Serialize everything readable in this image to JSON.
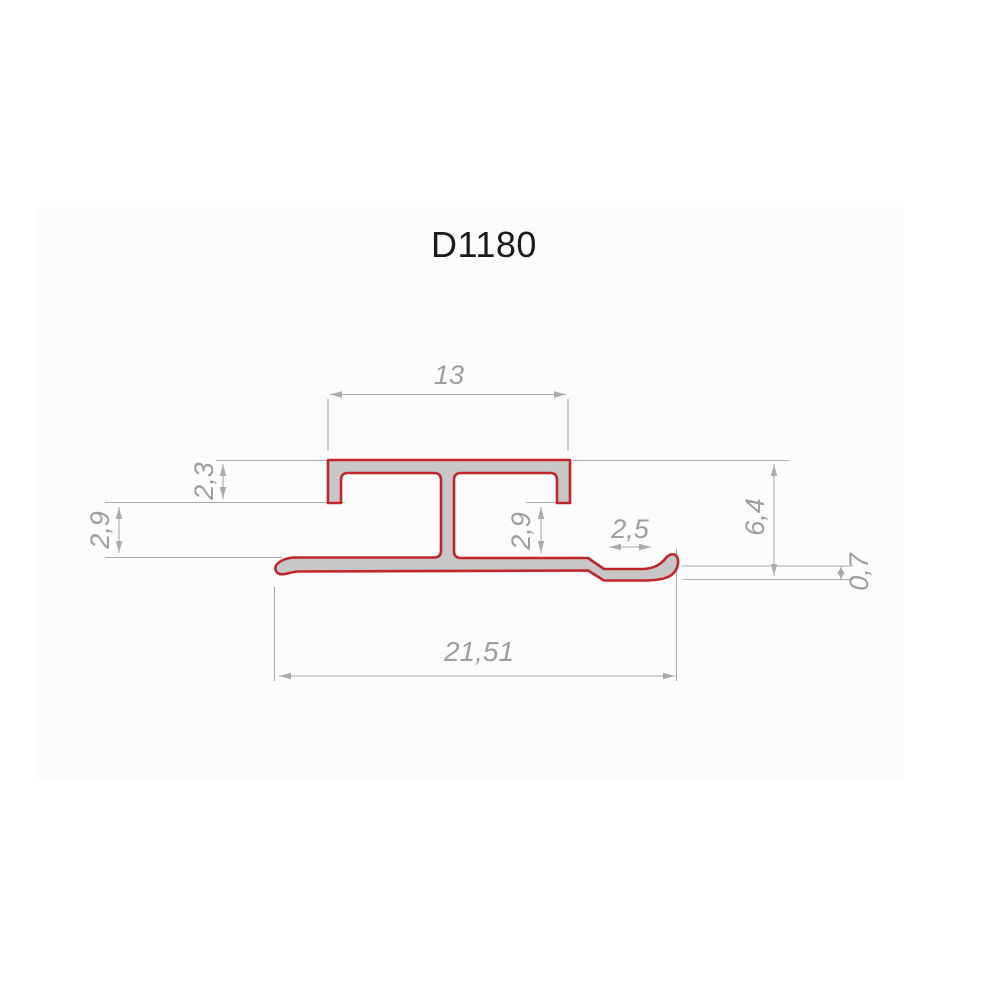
{
  "title": "D1180",
  "colors": {
    "background": "#ffffff",
    "panel": "#fcfcfc",
    "profile_fill": "#c7c7c7",
    "profile_outline": "#c0262b",
    "dim_line": "#aaaaaf",
    "dim_text": "#9d9da3",
    "title_text": "#1a1a1a"
  },
  "dimensions": {
    "top_width": "13",
    "hook_depth": "2,3",
    "left_gap": "2,9",
    "center_gap": "2,9",
    "step_width": "2,5",
    "overall_height": "6,4",
    "wall_thickness": "0,7",
    "overall_width": "21,51"
  }
}
